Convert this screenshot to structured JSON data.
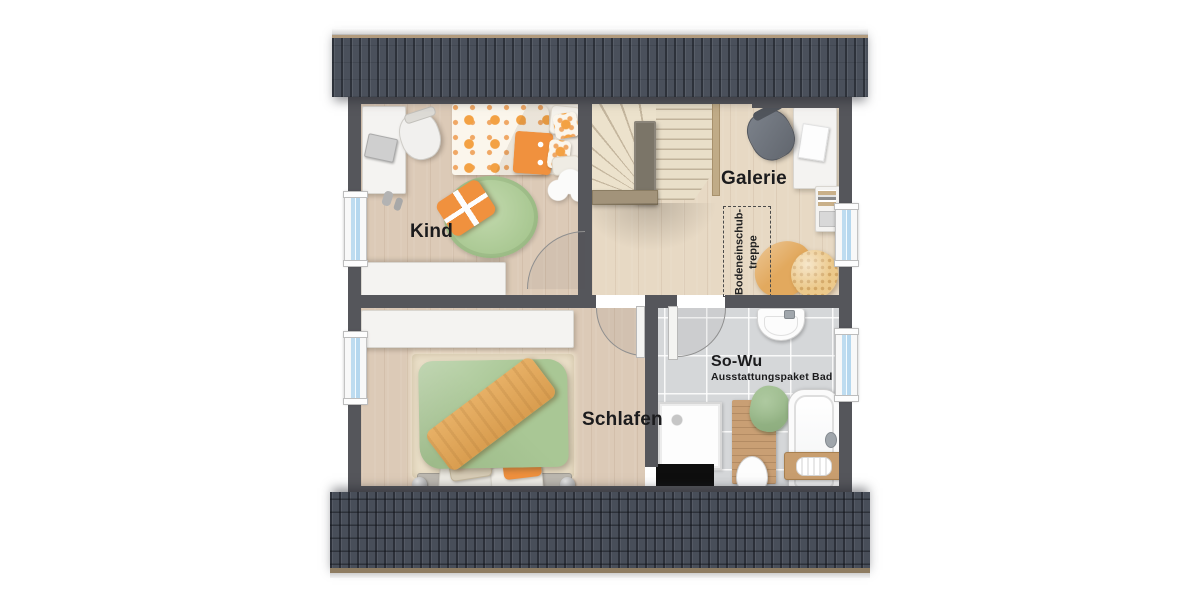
{
  "floor_plan": {
    "labels": {
      "kind": "Kind",
      "galerie": "Galerie",
      "schlafen": "Schlafen",
      "bad_title": "So-Wu",
      "bad_subtitle": "Ausstattungspaket Bad",
      "loft_line1": "Bodeneinschub-",
      "loft_line2": "treppe"
    },
    "rooms": [
      {
        "id": "kind",
        "label": "Kind"
      },
      {
        "id": "galerie",
        "label": "Galerie"
      },
      {
        "id": "schlafen",
        "label": "Schlafen"
      },
      {
        "id": "bad",
        "label": "So-Wu",
        "sublabel": "Ausstattungspaket Bad"
      }
    ],
    "annotations": [
      {
        "id": "loft-ladder",
        "text": "Bodeneinschub-treppe",
        "style": "dashed-box, vertical text"
      }
    ],
    "colors": {
      "roof": "#4a505b",
      "roof_stripe": "#3c414b",
      "fascia_wood": "#b29b7d",
      "wall": "#55565b",
      "wood_floor": "#dccab7",
      "wood_floor_light": "#e7d9c4",
      "stair_wood": "#ece2cc",
      "tile_floor": "#d5d7d9",
      "accent_orange": "#f0913e",
      "duvet_green": "#a9c795",
      "rug_green": "#b7d2a2",
      "rug_beige": "#eadfc8",
      "window_glass": "#bedcf0",
      "chimney": "#0e0e0e",
      "bath_mat_wood": "#c99f74",
      "blanket_tan": "#e2a95e",
      "white_furniture": "#f4f3f1"
    },
    "icons": {
      "window-icon": "white frame with blue glass bar",
      "door-swing-icon": "quarter arc",
      "stairs-icon": "fanned winder treads + straight flight",
      "loft-ladder-icon": "dashed rectangle",
      "bed-icon": "duvet with pillows",
      "desk-icon": "white rectangle",
      "office-chair-icon": "rounded seat",
      "wardrobe-icon": "long white rectangle",
      "rug-icon": "round / rectangular rug",
      "shower-icon": "square tray with drain",
      "bathtub-icon": "rounded tub with caddy",
      "toilet-icon": "oval bowl",
      "washbasin-icon": "rounded basin",
      "chimney-icon": "black rectangle",
      "towel-icon": "folded green towel",
      "bath-mat-icon": "wooden board"
    }
  }
}
